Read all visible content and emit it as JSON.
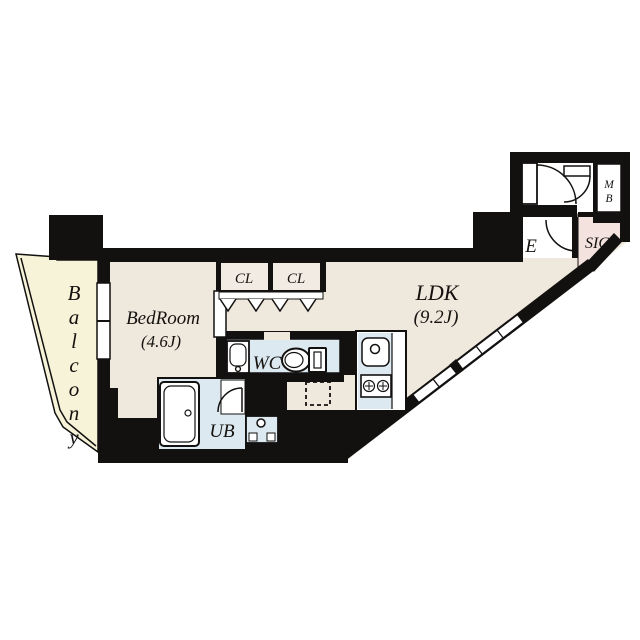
{
  "plan_title": "apartment-floor-plan",
  "colors": {
    "wall": "#131110",
    "floor_beige": "#efe8dd",
    "balcony_cream": "#f6f3d9",
    "wet_blue": "#dce9f0",
    "sic_pink": "#f3e2de",
    "white": "#ffffff"
  },
  "rooms": {
    "balcony": {
      "label": "Balcony"
    },
    "bedroom": {
      "label": "BedRoom",
      "size": "(4.6J)"
    },
    "ldk": {
      "label": "LDK",
      "size": "(9.2J)"
    },
    "closet1": {
      "label": "CL"
    },
    "closet2": {
      "label": "CL"
    },
    "wc": {
      "label": "WC"
    },
    "ub": {
      "label": "UB"
    },
    "entrance": {
      "label": "E"
    },
    "sic": {
      "label": "SIC"
    },
    "meter_box": {
      "line1": "M",
      "line2": "B"
    }
  }
}
